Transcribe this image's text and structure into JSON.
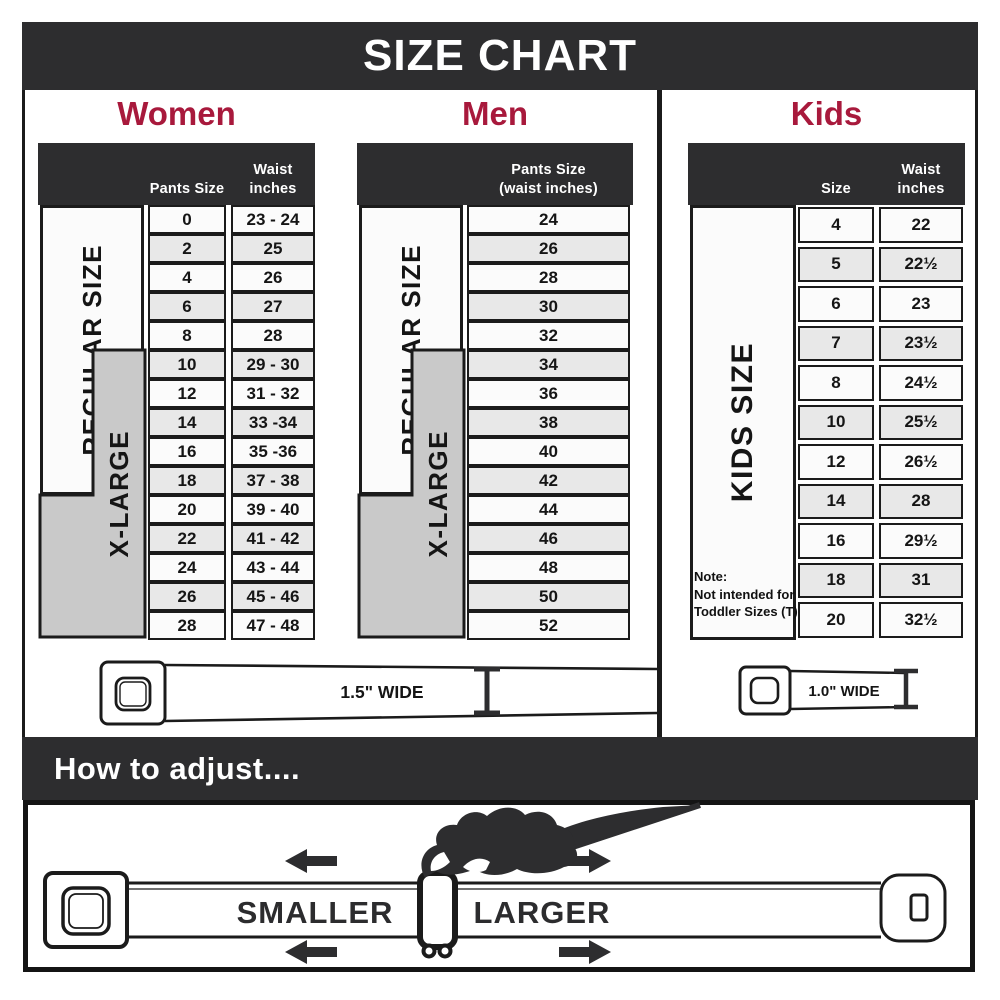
{
  "title": "SIZE CHART",
  "colors": {
    "accent": "#a8193c",
    "dark": "#2d2d2f",
    "ink": "#1b1b1b",
    "row_alt": "#e8e8e8",
    "row_light": "#fbfbfb",
    "xl_gray": "#c9c9c9"
  },
  "women": {
    "heading": "Women",
    "columns": {
      "pants": "Pants Size",
      "waist_line1": "Waist",
      "waist_line2": "inches"
    },
    "regular_label": "REGULAR SIZE",
    "xlarge_label": "X-LARGE",
    "rows": [
      {
        "size": "0",
        "waist": "23 - 24"
      },
      {
        "size": "2",
        "waist": "25"
      },
      {
        "size": "4",
        "waist": "26"
      },
      {
        "size": "6",
        "waist": "27"
      },
      {
        "size": "8",
        "waist": "28"
      },
      {
        "size": "10",
        "waist": "29 - 30"
      },
      {
        "size": "12",
        "waist": "31 - 32"
      },
      {
        "size": "14",
        "waist": "33 -34"
      },
      {
        "size": "16",
        "waist": "35 -36"
      },
      {
        "size": "18",
        "waist": "37 - 38"
      },
      {
        "size": "20",
        "waist": "39 - 40"
      },
      {
        "size": "22",
        "waist": "41 - 42"
      },
      {
        "size": "24",
        "waist": "43 - 44"
      },
      {
        "size": "26",
        "waist": "45 - 46"
      },
      {
        "size": "28",
        "waist": "47 - 48"
      }
    ]
  },
  "men": {
    "heading": "Men",
    "columns": {
      "line1": "Pants Size",
      "line2": "(waist inches)"
    },
    "regular_label": "REGULAR SIZE",
    "xlarge_label": "X-LARGE",
    "rows": [
      "24",
      "26",
      "28",
      "30",
      "32",
      "34",
      "36",
      "38",
      "40",
      "42",
      "44",
      "46",
      "48",
      "50",
      "52"
    ]
  },
  "kids": {
    "heading": "Kids",
    "columns": {
      "size": "Size",
      "waist_line1": "Waist",
      "waist_line2": "inches"
    },
    "side_label": "KIDS SIZE",
    "note": {
      "line1": "Note:",
      "line2": "Not intended for",
      "line3": "Toddler Sizes (T)"
    },
    "rows": [
      {
        "size": "4",
        "waist": "22"
      },
      {
        "size": "5",
        "waist": "22½"
      },
      {
        "size": "6",
        "waist": "23"
      },
      {
        "size": "7",
        "waist": "23½"
      },
      {
        "size": "8",
        "waist": "24½"
      },
      {
        "size": "10",
        "waist": "25½"
      },
      {
        "size": "12",
        "waist": "26½"
      },
      {
        "size": "14",
        "waist": "28"
      },
      {
        "size": "16",
        "waist": "29½"
      },
      {
        "size": "18",
        "waist": "31"
      },
      {
        "size": "20",
        "waist": "32½"
      }
    ]
  },
  "belts": {
    "adult_width_label": "1.5\" WIDE",
    "kids_width_label": "1.0\" WIDE"
  },
  "adjust": {
    "heading": "How to adjust....",
    "smaller_label": "SMALLER",
    "larger_label": "LARGER"
  }
}
